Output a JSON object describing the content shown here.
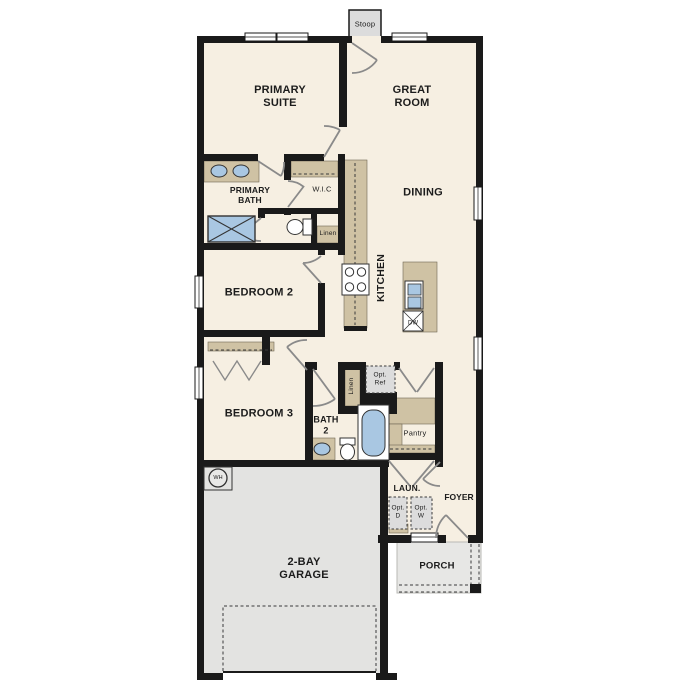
{
  "plan": {
    "stoop": "Stoop",
    "primary_suite": [
      "PRIMARY",
      "SUITE"
    ],
    "great_room": [
      "GREAT",
      "ROOM"
    ],
    "dining": "DINING",
    "primary_bath": [
      "PRIMARY",
      "BATH"
    ],
    "wic": "W.I.C",
    "linen_primary": "Linen",
    "kitchen": "KITCHEN",
    "bedroom2": "BEDROOM 2",
    "bedroom3": "BEDROOM 3",
    "bath2": [
      "BATH",
      "2"
    ],
    "linen_bath2": "Linen",
    "opt_ref": [
      "Opt.",
      "Ref"
    ],
    "pantry": "Pantry",
    "laundry": "LAUN.",
    "opt_dryer": [
      "Opt.",
      "D"
    ],
    "opt_washer": [
      "Opt.",
      "W"
    ],
    "foyer": "FOYER",
    "porch": "PORCH",
    "garage": [
      "2-BAY",
      "GARAGE"
    ],
    "water_heater": "WH",
    "dishwasher": "DW"
  },
  "colors": {
    "wall": "#1a1a1a",
    "floor": "#f6efe2",
    "casework": "#cfc2a4",
    "fixture_blue": "#a9c7e2",
    "garage_floor": "#e3e3e1",
    "porch_floor": "#e7e7e5",
    "stoop_floor": "#dcdcdc",
    "door_swing": "#8a8a8a"
  }
}
